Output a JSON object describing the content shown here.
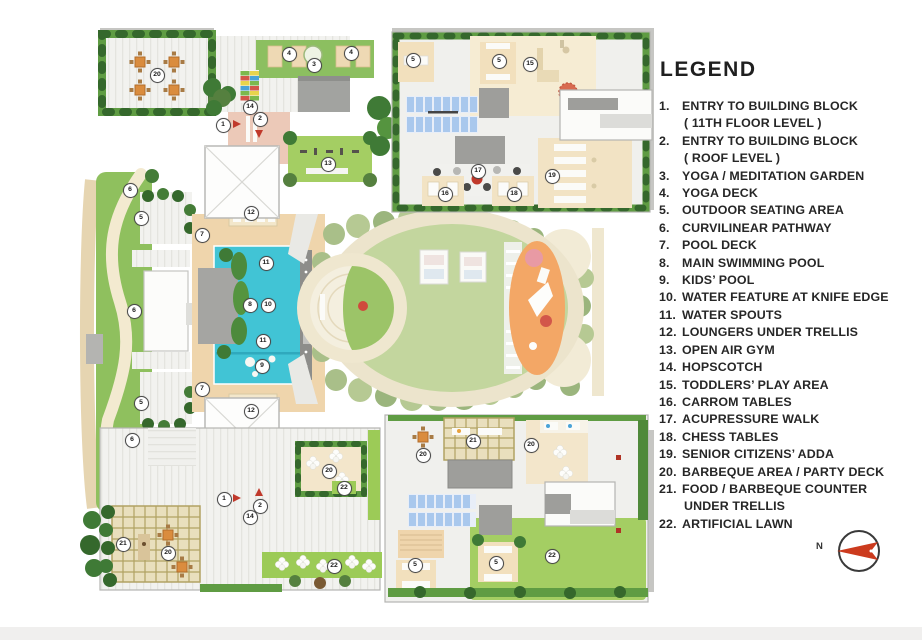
{
  "legend": {
    "title": "LEGEND",
    "items": [
      {
        "num": "1.",
        "label": "ENTRY TO BUILDING BLOCK",
        "label2": "( 11TH FLOOR LEVEL )"
      },
      {
        "num": "2.",
        "label": "ENTRY TO BUILDING BLOCK",
        "label2": "( ROOF LEVEL )"
      },
      {
        "num": "3.",
        "label": "YOGA / MEDITATION GARDEN"
      },
      {
        "num": "4.",
        "label": "YOGA DECK"
      },
      {
        "num": "5.",
        "label": "OUTDOOR SEATING AREA"
      },
      {
        "num": "6.",
        "label": "CURVILINEAR PATHWAY"
      },
      {
        "num": "7.",
        "label": "POOL DECK"
      },
      {
        "num": "8.",
        "label": "MAIN SWIMMING POOL"
      },
      {
        "num": "9.",
        "label": "KIDS’ POOL"
      },
      {
        "num": "10.",
        "label": "WATER FEATURE AT KNIFE EDGE"
      },
      {
        "num": "11.",
        "label": "WATER SPOUTS"
      },
      {
        "num": "12.",
        "label": "LOUNGERS UNDER TRELLIS"
      },
      {
        "num": "13.",
        "label": "OPEN AIR GYM"
      },
      {
        "num": "14.",
        "label": "HOPSCOTCH"
      },
      {
        "num": "15.",
        "label": "TODDLERS’ PLAY AREA"
      },
      {
        "num": "16.",
        "label": "CARROM TABLES"
      },
      {
        "num": "17.",
        "label": "ACUPRESSURE WALK"
      },
      {
        "num": "18.",
        "label": "CHESS TABLES"
      },
      {
        "num": "19.",
        "label": "SENIOR CITIZENS’ ADDA"
      },
      {
        "num": "20.",
        "label": "BARBEQUE AREA / PARTY DECK"
      },
      {
        "num": "21.",
        "label": "FOOD / BARBEQUE COUNTER",
        "label2": "UNDER TRELLIS"
      },
      {
        "num": "22.",
        "label": "ARTIFICIAL LAWN"
      }
    ]
  },
  "compass": {
    "north_label": "N"
  },
  "plan": {
    "markers": [
      {
        "n": "20",
        "x": 156,
        "y": 74
      },
      {
        "n": "4",
        "x": 288,
        "y": 53
      },
      {
        "n": "3",
        "x": 313,
        "y": 64
      },
      {
        "n": "4",
        "x": 350,
        "y": 52
      },
      {
        "n": "14",
        "x": 249,
        "y": 106
      },
      {
        "n": "1",
        "x": 222,
        "y": 124
      },
      {
        "n": "2",
        "x": 259,
        "y": 118
      },
      {
        "n": "13",
        "x": 327,
        "y": 163
      },
      {
        "n": "5",
        "x": 412,
        "y": 59
      },
      {
        "n": "5",
        "x": 498,
        "y": 60
      },
      {
        "n": "15",
        "x": 529,
        "y": 63
      },
      {
        "n": "17",
        "x": 477,
        "y": 170
      },
      {
        "n": "16",
        "x": 444,
        "y": 193
      },
      {
        "n": "18",
        "x": 513,
        "y": 193
      },
      {
        "n": "19",
        "x": 551,
        "y": 175
      },
      {
        "n": "12",
        "x": 250,
        "y": 212
      },
      {
        "n": "7",
        "x": 201,
        "y": 234
      },
      {
        "n": "11",
        "x": 265,
        "y": 262
      },
      {
        "n": "8",
        "x": 249,
        "y": 304
      },
      {
        "n": "10",
        "x": 267,
        "y": 304
      },
      {
        "n": "11",
        "x": 262,
        "y": 340
      },
      {
        "n": "9",
        "x": 261,
        "y": 365
      },
      {
        "n": "7",
        "x": 201,
        "y": 388
      },
      {
        "n": "12",
        "x": 250,
        "y": 410
      },
      {
        "n": "6",
        "x": 129,
        "y": 189
      },
      {
        "n": "5",
        "x": 140,
        "y": 217
      },
      {
        "n": "6",
        "x": 133,
        "y": 310
      },
      {
        "n": "5",
        "x": 140,
        "y": 402
      },
      {
        "n": "6",
        "x": 131,
        "y": 439
      },
      {
        "n": "21",
        "x": 122,
        "y": 543
      },
      {
        "n": "20",
        "x": 167,
        "y": 552
      },
      {
        "n": "14",
        "x": 249,
        "y": 516
      },
      {
        "n": "1",
        "x": 223,
        "y": 498
      },
      {
        "n": "2",
        "x": 259,
        "y": 505
      },
      {
        "n": "20",
        "x": 328,
        "y": 470
      },
      {
        "n": "22",
        "x": 343,
        "y": 487
      },
      {
        "n": "22",
        "x": 333,
        "y": 565
      },
      {
        "n": "21",
        "x": 472,
        "y": 440
      },
      {
        "n": "20",
        "x": 422,
        "y": 454
      },
      {
        "n": "20",
        "x": 530,
        "y": 444
      },
      {
        "n": "5",
        "x": 414,
        "y": 564
      },
      {
        "n": "5",
        "x": 495,
        "y": 562
      },
      {
        "n": "22",
        "x": 551,
        "y": 555
      }
    ],
    "entry_arrows": [
      {
        "dir": "right",
        "x": 233,
        "y": 124
      },
      {
        "dir": "down",
        "x": 259,
        "y": 130
      },
      {
        "dir": "right",
        "x": 233,
        "y": 498
      },
      {
        "dir": "up",
        "x": 259,
        "y": 496
      }
    ]
  },
  "colors": {
    "pool": "#41c4d5",
    "artificial_lawn": "#a4ce63",
    "soft_lawn": "#c3d69e",
    "hedge": "#5f9c43",
    "pool_deck_tan": "#efd5ac",
    "entry_pink": "#ecc9b8",
    "play_orange": "#f3a766",
    "accent_red": "#c0392b"
  }
}
